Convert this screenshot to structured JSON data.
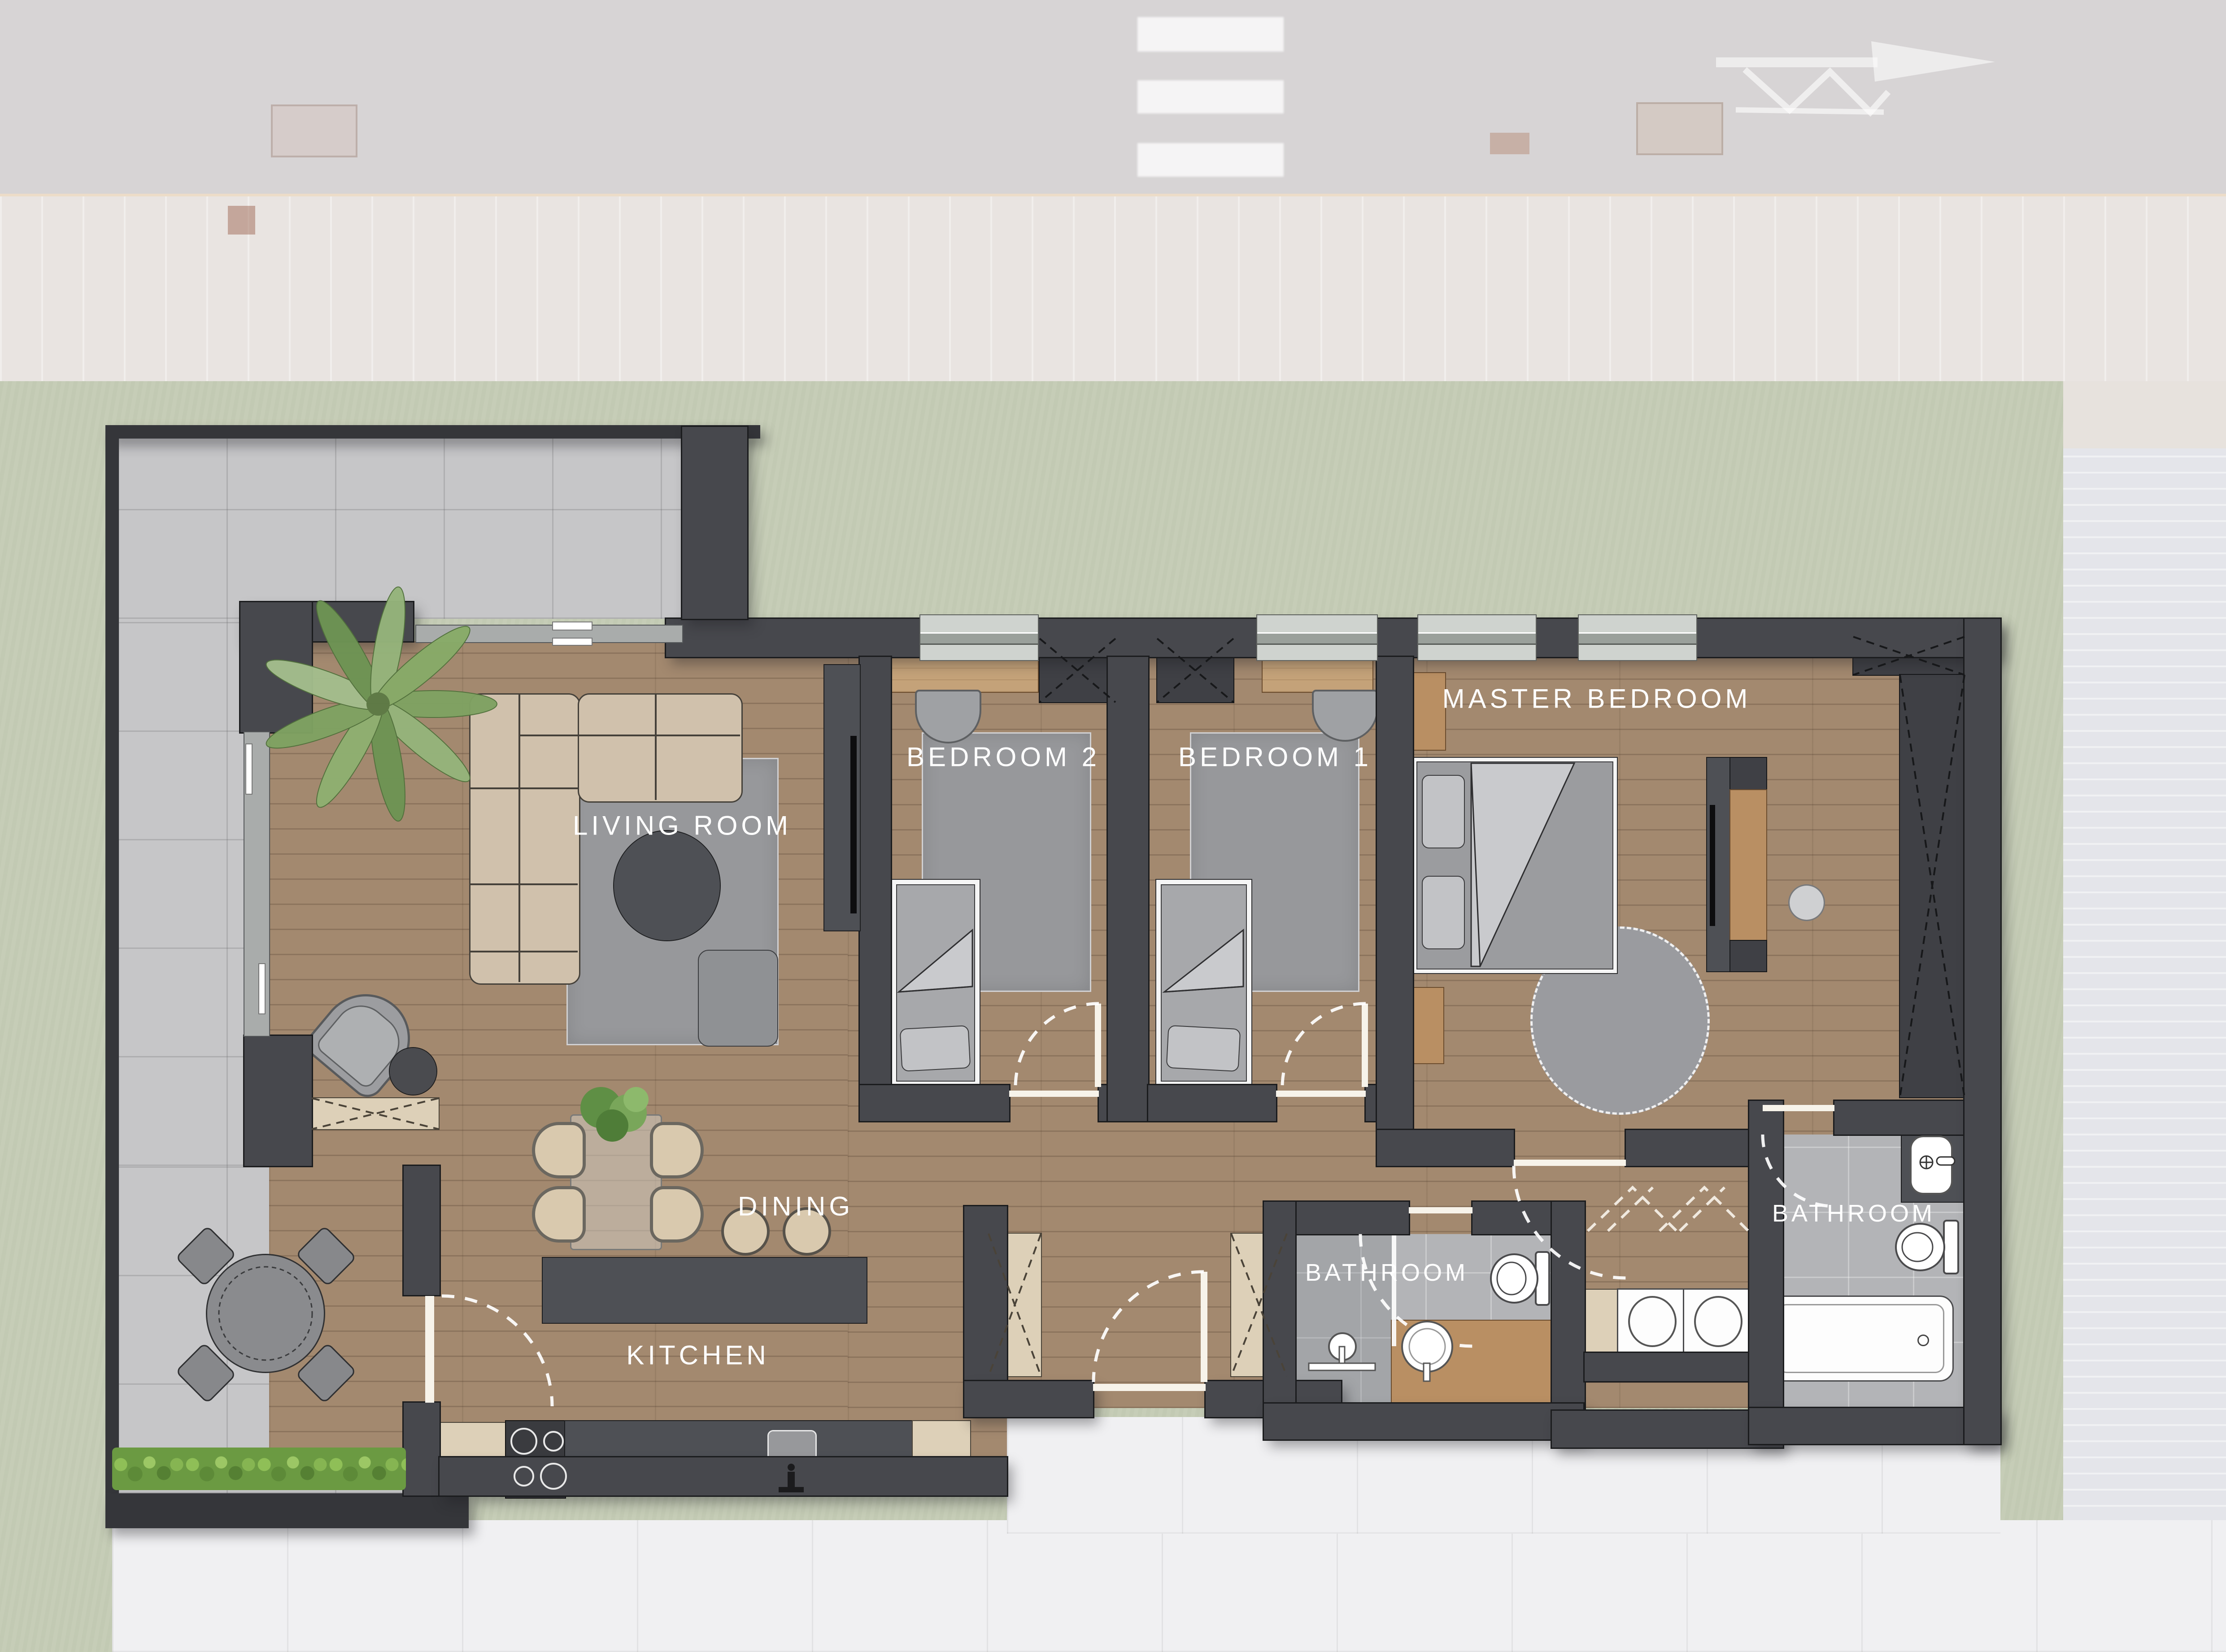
{
  "plan": {
    "type": "apartment-floor-plan",
    "labels": {
      "living_room": "LIVING ROOM",
      "bedroom2": "BEDROOM 2",
      "bedroom1": "BEDROOM 1",
      "master_bedroom": "MASTER BEDROOM",
      "dining": "DINING",
      "kitchen": "KITCHEN",
      "bathroom_small": "BATHROOM",
      "bathroom_main": "BATHROOM"
    },
    "colors": {
      "wall": "#47484d",
      "wood_floor": "#a3896f",
      "terrace_tile": "#c6c6c8",
      "bathroom_tile": "#b3b4b7",
      "hall_tile": "#f0f0f2",
      "lawn": "#c6cdb7",
      "rug": "#97989b",
      "sofa_beige": "#d0c1ac",
      "cabinet_beige": "#ddd0b8",
      "desk_wood": "#c4a279",
      "accent_wood": "#b98f63",
      "counter_dark": "#4e5055",
      "hedge_green": "#6b9a42",
      "label_text": "#ffffff"
    },
    "icons": {
      "palm-plant-icon": "top-view palm plant in living room corner",
      "dining-plant-icon": "green centerpiece on dining table",
      "hedge-icon": "hedge strip on lower terrace edge",
      "direction-arrow-icon": "faded site-plan arrow in top background",
      "door-swing-arc": "dashed quarter-circle door swings",
      "drying-rack-icon": "dashed drying rack symbol in hallway"
    }
  }
}
